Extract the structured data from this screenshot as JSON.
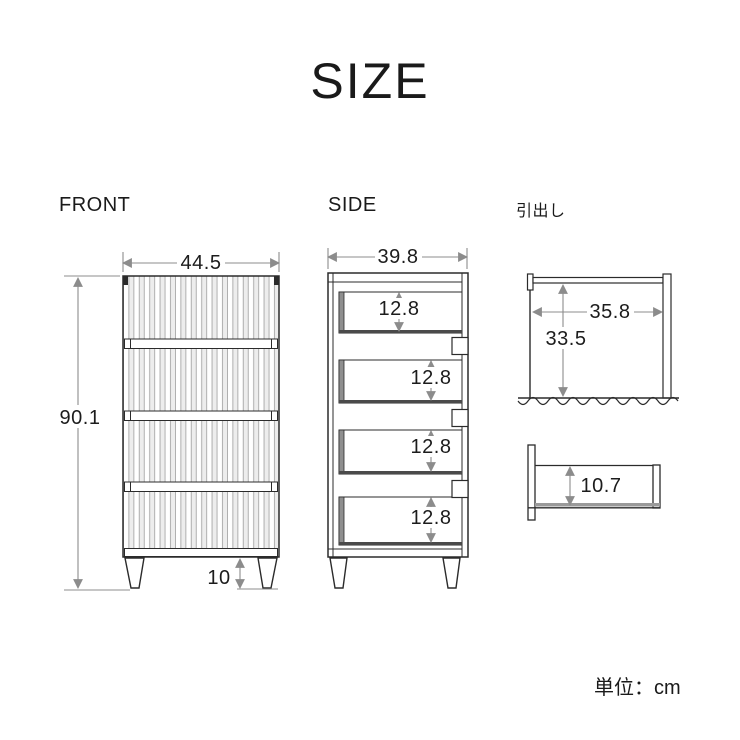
{
  "title": "SIZE",
  "unit_note": "単位：cm",
  "front_view": {
    "label": "FRONT",
    "width_cm": "44.5",
    "height_cm": "90.1",
    "leg_height_cm": "10"
  },
  "side_view": {
    "label": "SIDE",
    "depth_cm": "39.8",
    "drawer_heights_cm": [
      "12.8",
      "12.8",
      "12.8",
      "12.8"
    ]
  },
  "drawer_view": {
    "label": "引出し",
    "inner_width_cm": "35.8",
    "inner_depth_cm": "33.5",
    "inner_height_cm": "10.7"
  },
  "colors": {
    "ink": "#2b2b2b",
    "dimension": "#8c8c8c",
    "text": "#1c1c1c",
    "background": "#ffffff"
  }
}
